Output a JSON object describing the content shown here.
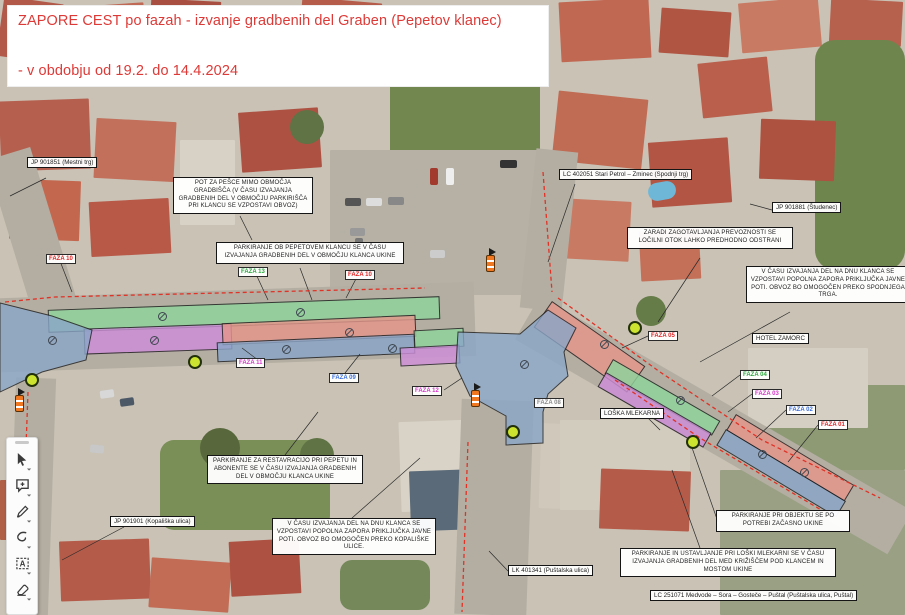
{
  "title": {
    "line1": "ZAPORE CEST po fazah - izvanje gradbenih del Graben (Pepetov klanec)",
    "line2": "- v obdobju od 19.2. do 14.4.2024",
    "color": "#dd3a37"
  },
  "road_labels": [
    {
      "text": "JP 901851 (Mestni trg)"
    },
    {
      "text": "LC 402051 Stari Petrol – Zminec (Spodnji trg)"
    },
    {
      "text": "JP 901881 (Študenec)"
    },
    {
      "text": "HOTEL ZAMORC"
    },
    {
      "text": "LOŠKA MLEKARNA"
    },
    {
      "text": "JP 901901 (Kopališka ulica)"
    },
    {
      "text": "LK 401341 (Puštalska ulica)"
    },
    {
      "text": "LC 251071 Medvode – Sora – Gosteče – Puštal (Puštalska ulica, Puštal)"
    }
  ],
  "instruction_boxes": [
    {
      "text": "POT ZA PEŠCE MIMO OBMOČJA GRADBIŠČA (V ČASU IZVAJANJA GRADBENIH DEL V OBMOČJU PARKIRIŠČA PRI KLANCU SE VZPOSTAVI OBVOZ)"
    },
    {
      "text": "PARKIRANJE OB PEPETOVEM KLANCU SE V ČASU IZVAJANJA GRADBENIH DEL V OBMOČJU KLANCA UKINE"
    },
    {
      "text": "ZARADI ZAGOTAVLJANJA PREVOZNOSTI SE LOČILNI OTOK LAHKO PREDHODNO ODSTRANI"
    },
    {
      "text": "V ČASU IZVAJANJA DEL NA DNU KLANCA SE VZPOSTAVI POPOLNA ZAPORA PRIKLJUČKA JAVNE POTI. OBVOZ BO OMOGOČEN PREKO SPODNJEGA TRGA."
    },
    {
      "text": "PARKIRANJE ZA RESTAVRACIJO PRI PEPETU IN ABONENTE SE V ČASU IZVAJANJA GRADBENIH DEL V OBMOČJU KLANCA UKINE"
    },
    {
      "text": "V ČASU IZVAJANJA DEL NA DNU KLANCA SE VZPOSTAVI POPOLNA ZAPORA PRIKLJUČKA JAVNE POTI. OBVOZ BO OMOGOČEN PREKO KOPALIŠKE ULICE."
    },
    {
      "text": "PARKIRANJE PRI OBJEKTU SE PO POTREBI ZAČASNO UKINE"
    },
    {
      "text": "PARKIRANJE IN USTAVLJANJE PRI LOŠKI MLEKARNI SE V ČASU IZVAJANJA GRADBENIH DEL MED KRIŽIŠČEM POD KLANCEM IN MOSTOM UKINE"
    }
  ],
  "phase_labels": [
    {
      "text": "FAZA 10",
      "color": "#e02424"
    },
    {
      "text": "FAZA 13",
      "color": "#27a83b"
    },
    {
      "text": "FAZA 10",
      "color": "#e02424"
    },
    {
      "text": "FAZA 11",
      "color": "#d438c8"
    },
    {
      "text": "FAZA 09",
      "color": "#3a6ed8"
    },
    {
      "text": "FAZA 12",
      "color": "#d438c8"
    },
    {
      "text": "FAZA 08",
      "color": "#8a8a8a"
    },
    {
      "text": "FAZA 05",
      "color": "#e02424"
    },
    {
      "text": "FAZA 04",
      "color": "#27a83b"
    },
    {
      "text": "FAZA 03",
      "color": "#d438c8"
    },
    {
      "text": "FAZA 02",
      "color": "#3a6ed8"
    },
    {
      "text": "FAZA 01",
      "color": "#e02424"
    }
  ],
  "colors": {
    "band_green": "#8fd49c",
    "band_purple": "#cd8ed8",
    "band_red": "#e5968b",
    "band_blue": "#8aa6c8",
    "closure_line": "#e03226",
    "pedestrian_marker": "#cce32f"
  },
  "toolbar": {
    "tools": [
      {
        "name": "select"
      },
      {
        "name": "comment"
      },
      {
        "name": "draw"
      },
      {
        "name": "highlight"
      },
      {
        "name": "text"
      },
      {
        "name": "erase"
      }
    ]
  }
}
